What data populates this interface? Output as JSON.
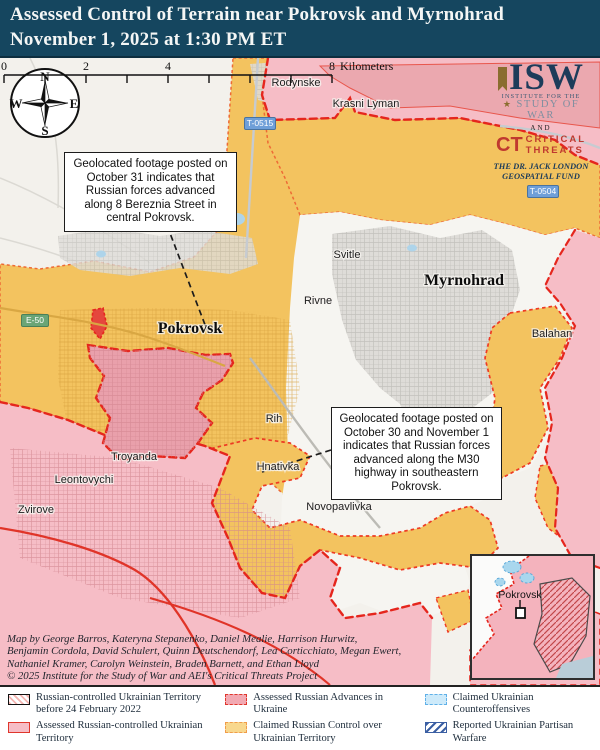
{
  "header": {
    "line1": "Assessed Control of Terrain near Pokrovsk and Myrnohrad",
    "line2": "November 1, 2025 at 1:30 PM ET"
  },
  "logo": {
    "isw": "ISW",
    "institute_small": "INSTITUTE FOR THE",
    "study_of_war": "STUDY OF WAR",
    "star": "★",
    "and": "AND",
    "ct": "CT",
    "critical": "CRITICAL",
    "threats": "THREATS",
    "fund_line1": "THE DR. JACK LONDON",
    "fund_line2": "GEOSPATIAL FUND"
  },
  "compass": {
    "n": "N",
    "s": "S",
    "e": "E",
    "w": "W"
  },
  "callouts": [
    {
      "text": "Geolocated footage posted on October 31 indicates that Russian forces advanced along 8 Bereznia Street in central Pokrovsk."
    },
    {
      "text": "Geolocated footage posted on October 30 and November 1 indicates that Russian forces advanced along the M30 highway in southeastern Pokrovsk."
    }
  ],
  "road_badges": [
    {
      "label": "T-0515"
    },
    {
      "label": "T-0504"
    },
    {
      "label": "E-50"
    }
  ],
  "towns": [
    {
      "name": "Rodynske"
    },
    {
      "name": "Krasni Lyman"
    },
    {
      "name": "Svitle"
    },
    {
      "name": "Rivne"
    },
    {
      "name": "Balahan"
    },
    {
      "name": "Rih"
    },
    {
      "name": "Hnativka"
    },
    {
      "name": "Troyanda"
    },
    {
      "name": "Leontovychi"
    },
    {
      "name": "Zvirove"
    },
    {
      "name": "Novopavlivka"
    }
  ],
  "cities": [
    {
      "name": "Pokrovsk"
    },
    {
      "name": "Myrnohrad"
    }
  ],
  "inset": {
    "label": "Pokrovsk"
  },
  "scalebar": {
    "t0": "0",
    "t2": "2",
    "t4": "4",
    "t8": "8",
    "unit": "Kilometers"
  },
  "credits": {
    "line1": "Map by George Barros, Kateryna Stepanenko, Daniel Mealie, Harrison Hurwitz,",
    "line2": "Benjamin Cordola, David Schulert, Quinn Deutschendorf, Lea Corticchiato, Megan Ewert,",
    "line3": "Nathaniel Kramer, Carolyn Weinstein, Braden Barnett, and Ethan Lloyd",
    "line4": "© 2025 Institute for the Study of War and AEI's Critical Threats Project"
  },
  "legend": {
    "items": [
      {
        "label": "Russian-controlled Ukrainian Territory before 24 February 2022"
      },
      {
        "label": "Assessed Russian-controlled Ukrainian Territory"
      },
      {
        "label": "Assessed Russian Advances in Ukraine"
      },
      {
        "label": "Claimed Russian Control over Ukrainian Territory"
      },
      {
        "label": "Claimed Ukrainian Counteroffensives"
      },
      {
        "label": "Reported Ukrainian Partisan Warfare"
      }
    ]
  },
  "colors": {
    "header_bg": "#15465f",
    "assessed_russian_control": "#f6bdc6",
    "assessed_russian_advance": "#e9a0ab",
    "claimed_russian_control": "#f3c35f",
    "frontline_red": "#e5261d",
    "claimed_border_orange": "#ee6a35",
    "counteroffensive_blue": "#cdeafa",
    "partisan_blue": "#3b5fa3"
  }
}
